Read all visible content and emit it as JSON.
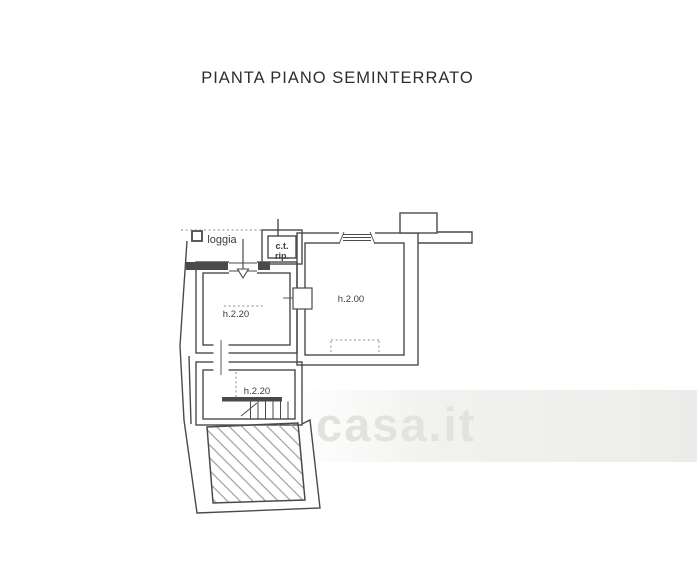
{
  "title": "PIANTA PIANO SEMINTERRATO",
  "plan": {
    "labels": {
      "loggia": "loggia",
      "ct": "c.t.",
      "rip": "rip.",
      "left_room_height": "h.2.20",
      "right_room_height": "h.2.00",
      "stair_room_height": "h.2.20"
    },
    "colors": {
      "wall": "#4a4a4a",
      "hatch": "#9a9f9f",
      "dotted": "#8a8a8a",
      "label": "#3c3c3c"
    }
  },
  "watermark": {
    "text": "casa.it",
    "color": "#e2e2de"
  }
}
